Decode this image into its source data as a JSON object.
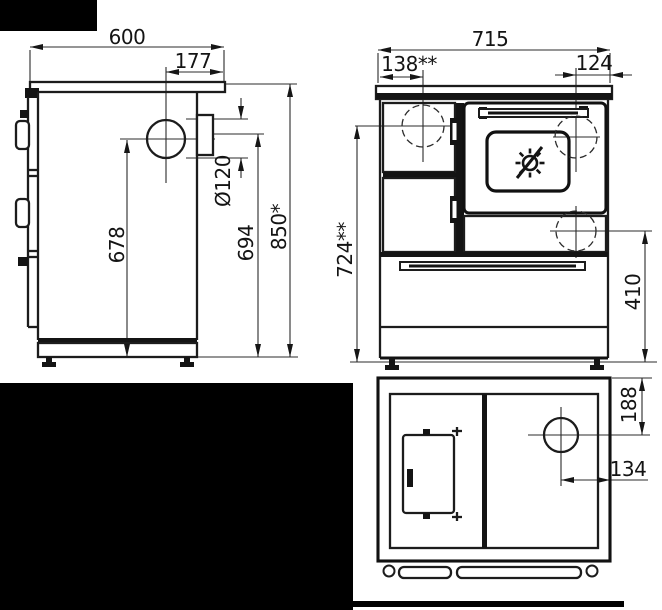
{
  "drawing": {
    "side_view": {
      "depth": "600",
      "flue_offset_from_back": "177",
      "flue_diameter": "Ø120",
      "flue_axis_height": "678",
      "collar_axis_height": "694",
      "worktop_height": "850*"
    },
    "front_view": {
      "width": "715",
      "firebox_axis_offset": "138**",
      "flue_axis_offset": "124",
      "firebox_axis_height": "724**",
      "rear_flue_axis_height": "410"
    },
    "bottom_view": {
      "flue_axis_from_top": "188",
      "flue_axis_from_right": "134"
    }
  }
}
